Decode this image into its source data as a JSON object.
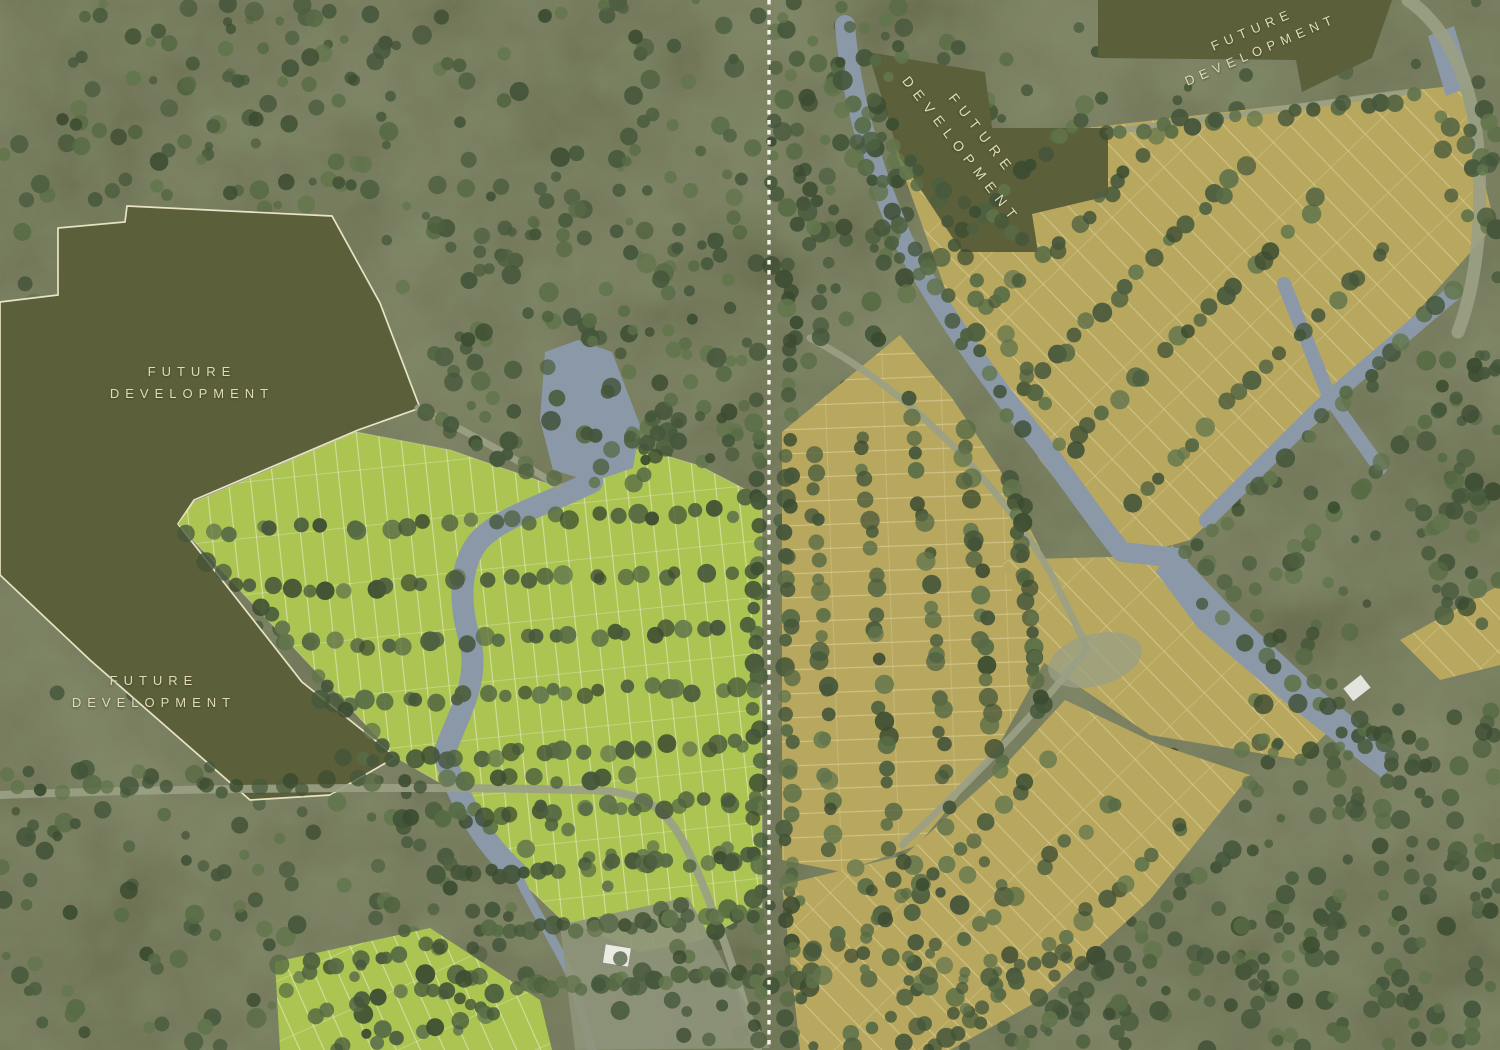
{
  "map_kind": "masterplan-aerial-rendering",
  "labels": [
    {
      "id": "west-upper",
      "line1": "FUTURE",
      "line2": "DEVELOPMENT"
    },
    {
      "id": "west-lower",
      "line1": "FUTURE",
      "line2": "DEVELOPMENT"
    },
    {
      "id": "east-central",
      "line1": "FUTURE",
      "line2": "DEVELOPMENT"
    },
    {
      "id": "east-top",
      "line1": "FUTURE",
      "line2": "DEVELOPMENT"
    }
  ],
  "colors": {
    "ground": "#6a6e50",
    "forest_dark": "#42502f",
    "parcel": "#5c603a",
    "parcel_outline": "#e9e3c6",
    "plots_west": "#abc452",
    "plot_line_west": "#eef0d2",
    "plots_east": "#b8a85f",
    "plot_line_east": "#e4d6a4",
    "water": "#8b98a7",
    "road": "#9aa084",
    "divider": "#f6f4e9",
    "label_text": "#e2dbba"
  },
  "divider": {
    "style": "dashed",
    "orientation": "vertical"
  }
}
